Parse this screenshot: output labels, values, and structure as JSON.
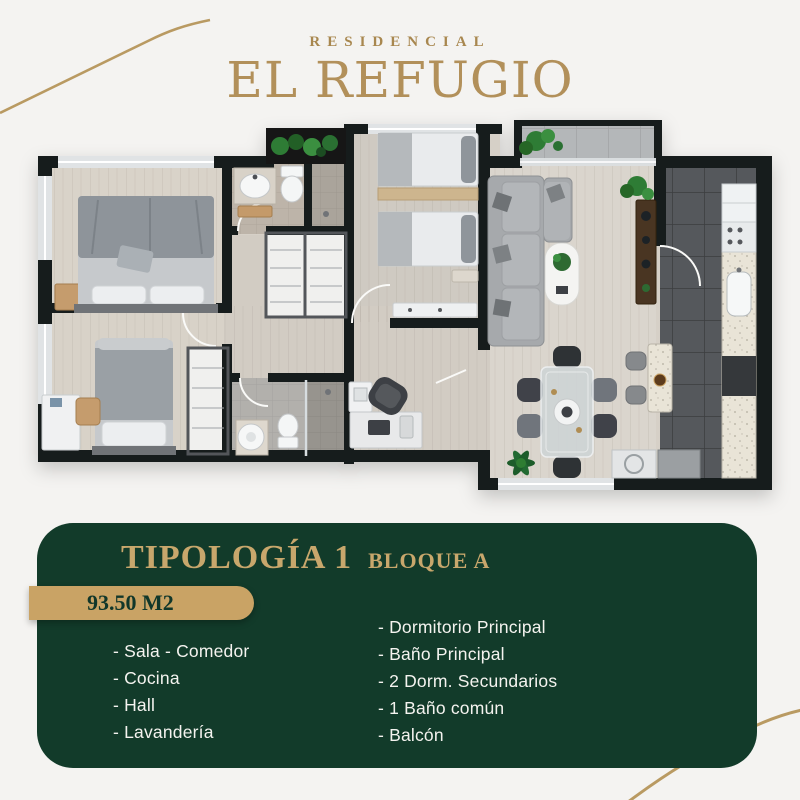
{
  "brand": {
    "kicker": "RESIDENCIAL",
    "name": "EL REFUGIO"
  },
  "info_panel": {
    "title": "TIPOLOGÍA 1",
    "block": "BLOQUE A",
    "area_badge": "93.50 M2",
    "features_left": [
      "- Sala - Comedor",
      "- Cocina",
      "- Hall",
      "- Lavandería"
    ],
    "features_right": [
      "- Dormitorio Principal",
      "- Baño Principal",
      "- 2 Dorm. Secundarios",
      "- 1 Baño común",
      "- Balcón"
    ]
  },
  "colors": {
    "background": "#f4f3f1",
    "panel_green": "#123b2a",
    "logo_gold": "#b2905a",
    "accent_tan": "#c9a365",
    "badge_text": "#11372a",
    "wall_black": "#191b1d",
    "wood_floor": "#d6d0c7",
    "kitchen_tile": "#55585b",
    "list_text": "#f4f3ef"
  }
}
